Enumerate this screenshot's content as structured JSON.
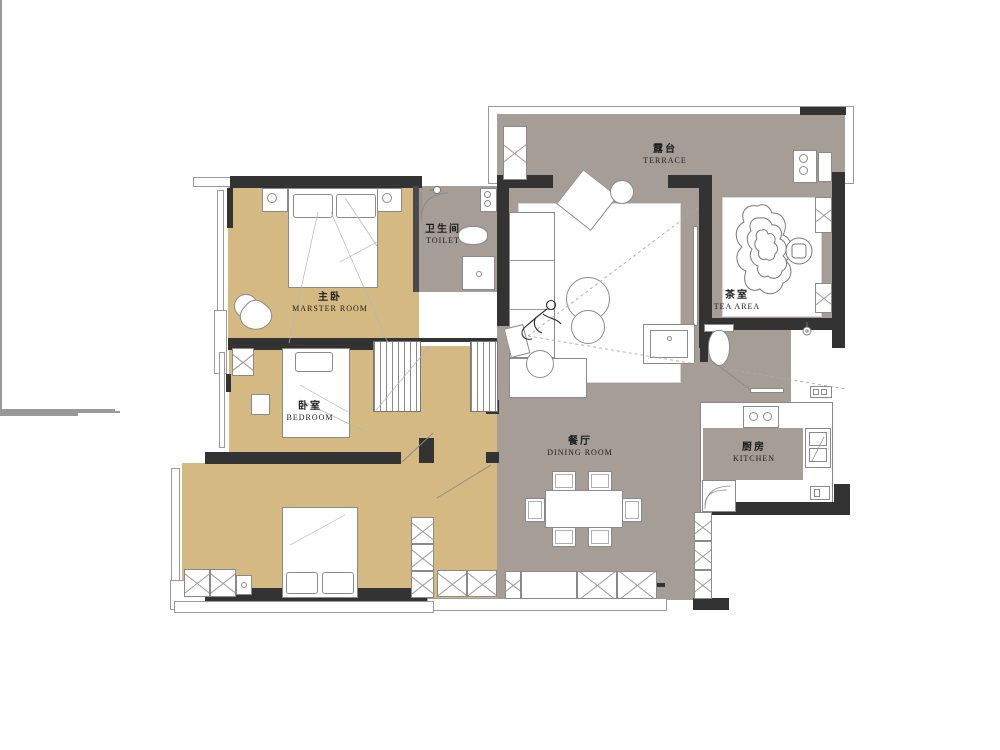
{
  "colors": {
    "floor_tan": "#d4ba82",
    "floor_gray": "#a59d96",
    "wall": "#333333"
  },
  "rooms": {
    "master": {
      "zh": "主卧",
      "en": "MARSTER ROOM"
    },
    "toilet": {
      "zh": "卫生间",
      "en": "TOILET"
    },
    "bedroom": {
      "zh": "卧室",
      "en": "BEDROOM"
    },
    "terrace": {
      "zh": "露台",
      "en": "TERRACE"
    },
    "tea": {
      "zh": "茶室",
      "en": "TEA AREA"
    },
    "dining": {
      "zh": "餐厅",
      "en": "DINING ROOM"
    },
    "kitchen": {
      "zh": "厨房",
      "en": "KITCHEN"
    }
  }
}
